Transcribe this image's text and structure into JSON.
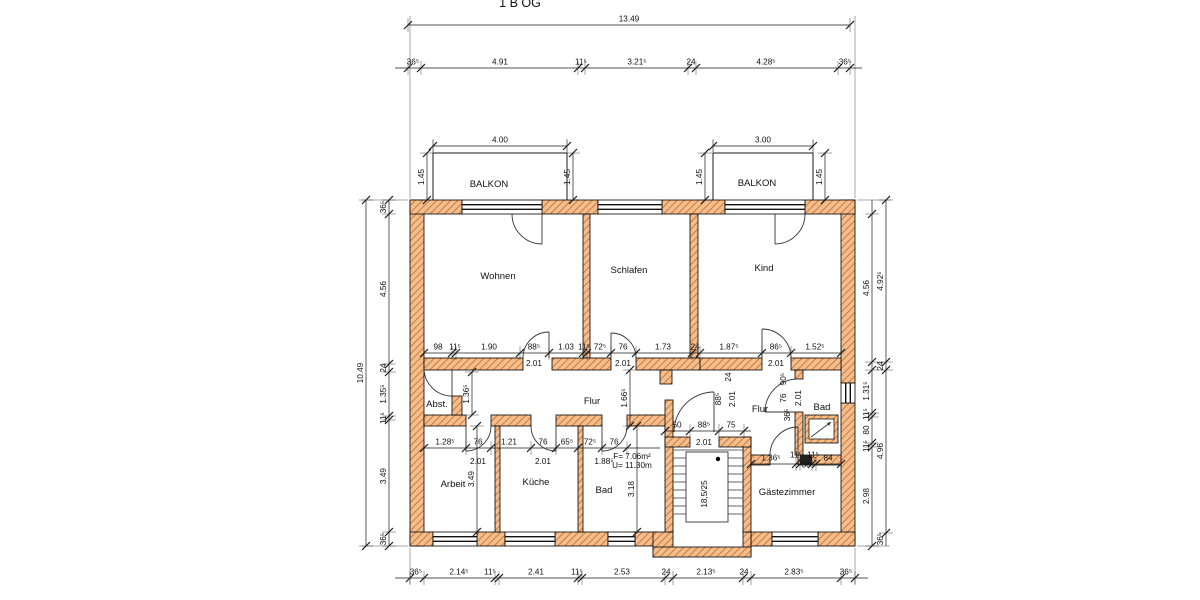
{
  "meta": {
    "floor_label": "1 B OG"
  },
  "plan": {
    "room_names": [
      "BALKON",
      "BALKON",
      "Wohnen",
      "Schlafen",
      "Kind",
      "Abst.",
      "Flur",
      "Flur",
      "Bad",
      "Arbeit",
      "Küche",
      "Bad",
      "Gästezimmer"
    ],
    "stair_note": "18,5/25",
    "area_note": "F= 7.06m²",
    "perimeter_note": "U= 11.30m",
    "wall_fill_color": "#f4bd8c",
    "wall_hatch_color": "#c06a2a",
    "line_color": "#1a1a1a"
  },
  "rooms": [
    {
      "t": "BALKON",
      "x": 489,
      "y": 187,
      "size": 10.5
    },
    {
      "t": "BALKON",
      "x": 757,
      "y": 186,
      "size": 10.5
    },
    {
      "t": "Wohnen",
      "x": 498,
      "y": 279
    },
    {
      "t": "Schlafen",
      "x": 629,
      "y": 273
    },
    {
      "t": "Kind",
      "x": 764,
      "y": 271
    },
    {
      "t": "Abst.",
      "x": 437,
      "y": 407,
      "size": 8
    },
    {
      "t": "Flur",
      "x": 592,
      "y": 404,
      "size": 8.5
    },
    {
      "t": "Flur",
      "x": 760,
      "y": 412,
      "size": 8
    },
    {
      "t": "Bad",
      "x": 822,
      "y": 410,
      "size": 8.5
    },
    {
      "t": "Arbeit",
      "x": 453,
      "y": 487
    },
    {
      "t": "Küche",
      "x": 536,
      "y": 485
    },
    {
      "t": "Bad",
      "x": 604,
      "y": 493
    },
    {
      "t": "Gästezimmer",
      "x": 787,
      "y": 495,
      "size": 8.5
    }
  ],
  "chains": [
    {
      "dir": "h",
      "pos": 25,
      "s": 408,
      "e": 850,
      "ticks": [
        408,
        850
      ],
      "labels": [
        {
          "t": "13.49",
          "p": 629
        }
      ]
    },
    {
      "dir": "h",
      "pos": 68,
      "s": 395,
      "e": 862,
      "ticks": [
        408,
        421,
        578,
        585,
        688,
        696,
        838,
        850
      ],
      "labels": [
        {
          "t": "36⁵",
          "p": 413
        },
        {
          "t": "4.91",
          "p": 500
        },
        {
          "t": "11⁵",
          "p": 581
        },
        {
          "t": "3.21⁵",
          "p": 637
        },
        {
          "t": "24",
          "p": 691
        },
        {
          "t": "4.28⁵",
          "p": 766
        },
        {
          "t": "36⁵",
          "p": 845
        }
      ]
    },
    {
      "dir": "h",
      "pos": 146,
      "s": 433,
      "e": 567,
      "ticks": [
        433,
        567
      ],
      "labels": [
        {
          "t": "4.00",
          "p": 500
        }
      ]
    },
    {
      "dir": "h",
      "pos": 146,
      "s": 713,
      "e": 813,
      "ticks": [
        713,
        813
      ],
      "labels": [
        {
          "t": "3.00",
          "p": 763
        }
      ]
    },
    {
      "dir": "h",
      "pos": 578,
      "s": 395,
      "e": 868,
      "ticks": [
        410,
        424,
        495,
        499,
        578,
        582,
        665,
        673,
        743,
        751,
        841,
        855
      ],
      "labels": [
        {
          "t": "36⁵",
          "p": 416
        },
        {
          "t": "2.14⁵",
          "p": 459
        },
        {
          "t": "11⁵",
          "p": 490
        },
        {
          "t": "2.41",
          "p": 536
        },
        {
          "t": "11⁵",
          "p": 577
        },
        {
          "t": "2.53",
          "p": 622
        },
        {
          "t": "24",
          "p": 666
        },
        {
          "t": "2.13⁵",
          "p": 706
        },
        {
          "t": "24",
          "p": 744
        },
        {
          "t": "2.83⁵",
          "p": 794
        },
        {
          "t": "36⁵",
          "p": 846
        }
      ]
    },
    {
      "dir": "h",
      "pos": 353,
      "s": 424,
      "e": 841,
      "ticks": [
        424,
        452,
        456,
        520,
        549,
        583,
        587,
        611,
        636,
        692,
        700,
        762,
        791,
        841
      ],
      "labels": [
        {
          "t": "98",
          "p": 438
        },
        {
          "t": "11⁵",
          "p": 455
        },
        {
          "t": "1.90",
          "p": 489
        },
        {
          "t": "88⁵",
          "p": 534
        },
        {
          "t": "1.03",
          "p": 566
        },
        {
          "t": "11⁵",
          "p": 584
        },
        {
          "t": "72⁵",
          "p": 600
        },
        {
          "t": "76",
          "p": 623
        },
        {
          "t": "1.73",
          "p": 663
        },
        {
          "t": "24",
          "p": 695
        },
        {
          "t": "1.87⁵",
          "p": 729
        },
        {
          "t": "86⁵",
          "p": 776
        },
        {
          "t": "1.52⁵",
          "p": 815
        }
      ]
    },
    {
      "dir": "h",
      "pos": 448,
      "s": 424,
      "e": 660,
      "ticks": [
        424,
        466,
        491,
        531,
        556,
        578,
        602,
        627
      ],
      "labels": [
        {
          "t": "1.28⁵",
          "p": 445
        },
        {
          "t": "76",
          "p": 478
        },
        {
          "t": "1.21",
          "p": 509
        },
        {
          "t": "76",
          "p": 543
        },
        {
          "t": "65⁵",
          "p": 567
        },
        {
          "t": "72⁵",
          "p": 590
        },
        {
          "t": "76",
          "p": 614
        }
      ]
    },
    {
      "dir": "h",
      "pos": 431,
      "s": 665,
      "e": 751,
      "ticks": [
        665,
        690,
        719,
        744
      ],
      "labels": [
        {
          "t": "50",
          "p": 677
        },
        {
          "t": "88⁵",
          "p": 704
        },
        {
          "t": "75",
          "p": 731
        }
      ]
    },
    {
      "dir": "h",
      "pos": 464,
      "s": 751,
      "e": 841,
      "ticks": [
        751,
        796,
        800,
        812,
        816,
        841
      ],
      "labels": [
        {
          "t": "1.36⁵",
          "p": 771
        },
        {
          "t": "11⁵",
          "p": 796,
          "dy": -3
        },
        {
          "t": "36",
          "p": 806,
          "dy": 7
        },
        {
          "t": "11⁵",
          "p": 813,
          "dy": -3
        },
        {
          "t": "84",
          "p": 828
        }
      ]
    },
    {
      "dir": "v",
      "pos": 366,
      "s": 200,
      "e": 546,
      "ticks": [
        200,
        546
      ],
      "labels": [
        {
          "t": "10.49",
          "p": 373
        }
      ]
    },
    {
      "dir": "v",
      "pos": 389,
      "s": 200,
      "e": 546,
      "ticks": [
        200,
        214,
        364,
        372,
        416,
        420,
        532,
        546
      ],
      "labels": [
        {
          "t": "36⁵",
          "p": 207
        },
        {
          "t": "4.56",
          "p": 289
        },
        {
          "t": "24",
          "p": 368
        },
        {
          "t": "1.35⁵",
          "p": 394
        },
        {
          "t": "11⁵",
          "p": 418
        },
        {
          "t": "3.49",
          "p": 476
        },
        {
          "t": "36⁵",
          "p": 539
        }
      ]
    },
    {
      "dir": "v",
      "pos": 872,
      "s": 200,
      "e": 546,
      "ticks": [
        214,
        362,
        370,
        413,
        417,
        443,
        447,
        546
      ],
      "labels": [
        {
          "t": "4.56",
          "p": 288
        },
        {
          "t": "1.31⁵",
          "p": 391
        },
        {
          "t": "11⁵",
          "p": 414
        },
        {
          "t": "80",
          "p": 430
        },
        {
          "t": "11⁵",
          "p": 446
        },
        {
          "t": "2.98",
          "p": 496
        }
      ]
    },
    {
      "dir": "v",
      "pos": 886,
      "s": 200,
      "e": 546,
      "ticks": [
        200,
        362,
        370,
        533
      ],
      "labels": [
        {
          "t": "4.92⁵",
          "p": 281
        },
        {
          "t": "24",
          "p": 366
        },
        {
          "t": "4.96",
          "p": 451
        },
        {
          "t": "36⁵",
          "p": 539
        }
      ]
    },
    {
      "dir": "v",
      "pos": 427,
      "s": 153,
      "e": 200,
      "ticks": [
        153,
        200
      ],
      "labels": [
        {
          "t": "1.45",
          "p": 177
        }
      ]
    },
    {
      "dir": "v",
      "pos": 573,
      "s": 153,
      "e": 200,
      "ticks": [
        153,
        200
      ],
      "labels": [
        {
          "t": "1.45",
          "p": 177
        }
      ]
    },
    {
      "dir": "v",
      "pos": 705,
      "s": 153,
      "e": 200,
      "ticks": [
        153,
        200
      ],
      "labels": [
        {
          "t": "1.45",
          "p": 177
        }
      ]
    },
    {
      "dir": "v",
      "pos": 825,
      "s": 153,
      "e": 200,
      "ticks": [
        153,
        200
      ],
      "labels": [
        {
          "t": "1.45",
          "p": 177
        }
      ]
    },
    {
      "dir": "v",
      "pos": 472,
      "s": 372,
      "e": 415,
      "ticks": [
        372,
        415
      ],
      "labels": [
        {
          "t": "1.36⁵",
          "p": 394
        }
      ]
    },
    {
      "dir": "v",
      "pos": 630,
      "s": 370,
      "e": 426,
      "ticks": [
        370,
        426
      ],
      "labels": [
        {
          "t": "1.66⁵",
          "p": 398
        }
      ]
    },
    {
      "dir": "v",
      "pos": 477,
      "s": 426,
      "e": 532,
      "ticks": [
        426,
        532
      ],
      "labels": [
        {
          "t": "3.49",
          "p": 479
        }
      ]
    },
    {
      "dir": "v",
      "pos": 637,
      "s": 426,
      "e": 532,
      "ticks": [
        426,
        532
      ],
      "labels": [
        {
          "t": "3.18",
          "p": 489
        }
      ]
    }
  ],
  "texts": [
    {
      "t": "2.01",
      "x": 534,
      "y": 366
    },
    {
      "t": "2.01",
      "x": 623,
      "y": 366
    },
    {
      "t": "2.01",
      "x": 776,
      "y": 366
    },
    {
      "t": "2.01",
      "x": 478,
      "y": 464
    },
    {
      "t": "2.01",
      "x": 543,
      "y": 464
    },
    {
      "t": "1.88⁵",
      "x": 604,
      "y": 464
    },
    {
      "t": "F= 7.06m²",
      "x": 632,
      "y": 459,
      "size": 6.8
    },
    {
      "t": "U= 11.30m",
      "x": 632,
      "y": 468,
      "size": 6.8
    },
    {
      "t": "2.01",
      "x": 704,
      "y": 445
    },
    {
      "t": "24",
      "x": 731,
      "y": 377,
      "rot": 1
    },
    {
      "t": "88⁵",
      "x": 721,
      "y": 399,
      "rot": 1
    },
    {
      "t": "2.01",
      "x": 735,
      "y": 399,
      "rot": 1
    },
    {
      "t": "90⁵",
      "x": 786,
      "y": 379,
      "rot": 1
    },
    {
      "t": "76",
      "x": 786,
      "y": 398,
      "rot": 1
    },
    {
      "t": "2.01",
      "x": 801,
      "y": 398,
      "rot": 1
    },
    {
      "t": "36⁵",
      "x": 790,
      "y": 415,
      "rot": 1
    },
    {
      "t": "18,5/25",
      "x": 707,
      "y": 494,
      "rot": 1,
      "size": 6.5
    }
  ]
}
